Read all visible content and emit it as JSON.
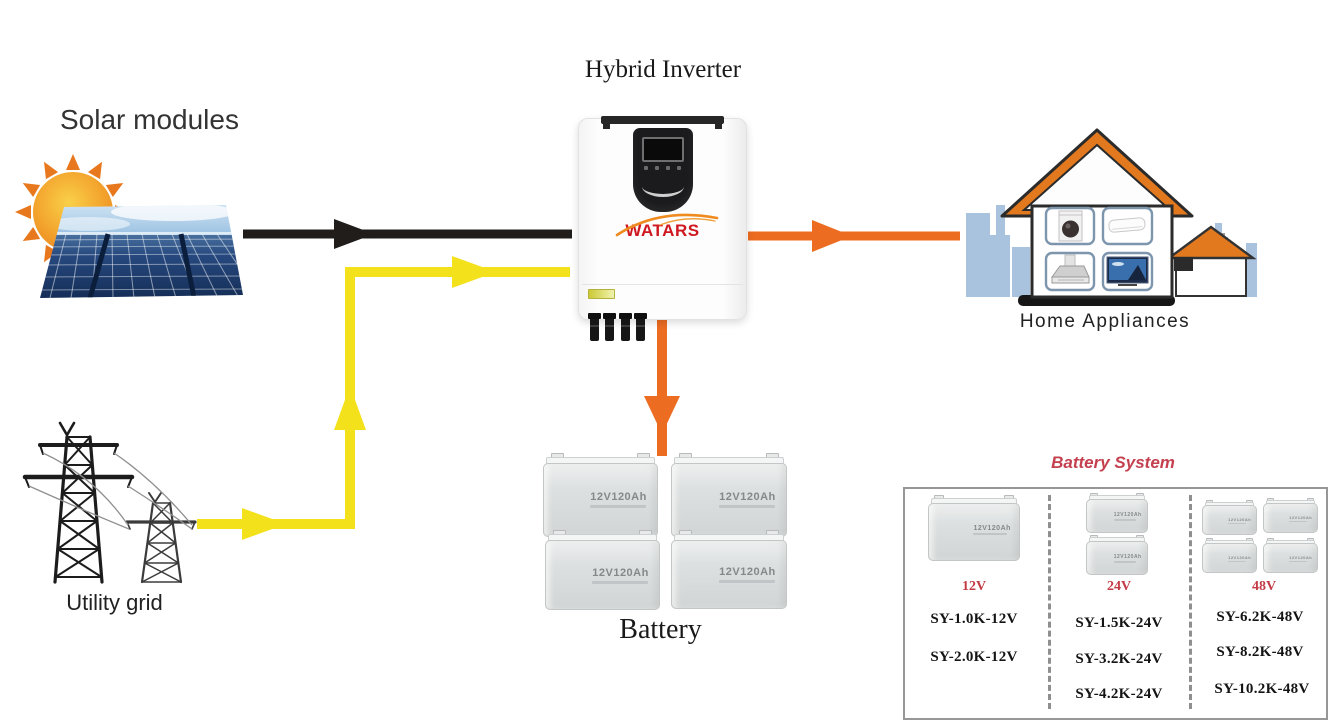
{
  "labels": {
    "solar": "Solar modules",
    "inverter_title": "Hybrid Inverter",
    "inverter_brand": "WATARS",
    "utility": "Utility grid",
    "home": "Home Appliances",
    "battery": "Battery",
    "battery_unit": "12V120Ah"
  },
  "battery_system": {
    "title": "Battery System",
    "columns": [
      {
        "voltage": "12V",
        "battery_count": 1,
        "models": [
          "SY-1.0K-12V",
          "SY-2.0K-12V"
        ]
      },
      {
        "voltage": "24V",
        "battery_count": 2,
        "models": [
          "SY-1.5K-24V",
          "SY-3.2K-24V",
          "SY-4.2K-24V"
        ]
      },
      {
        "voltage": "48V",
        "battery_count": 4,
        "models": [
          "SY-6.2K-48V",
          "SY-8.2K-48V",
          "SY-10.2K-48V"
        ]
      }
    ]
  },
  "colors": {
    "solar_arrow": "#201d1b",
    "grid_arrow": "#f3e11c",
    "output_arrow": "#ec6c21",
    "accent_red": "#c23b45",
    "roof_orange": "#e2791f",
    "skyline_blue": "#a9c3df"
  }
}
